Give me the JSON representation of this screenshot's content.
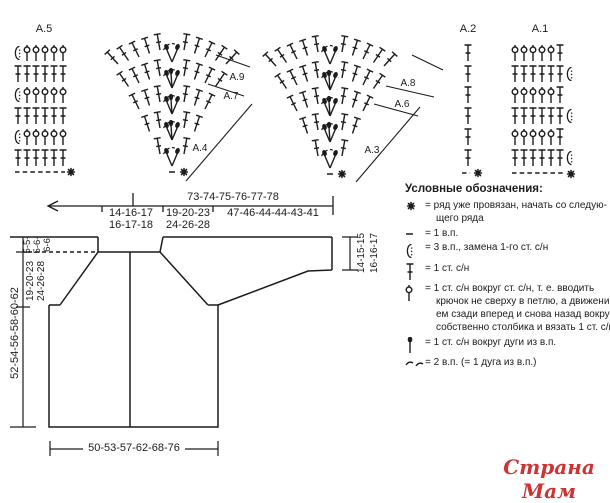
{
  "labels": {
    "a5": "А.5",
    "a2": "А.2",
    "a1": "А.1",
    "a9": "А.9",
    "a7": "А.7",
    "a4": "А.4",
    "a8": "А.8",
    "a6": "А.6",
    "a3": "А.3"
  },
  "top_dimension": {
    "total": "73-74-75-76-77-78",
    "seg1": [
      "14-16-17",
      "16-17-18"
    ],
    "seg2": [
      "19-20-23",
      "24-26-28"
    ],
    "seg3": "47-46-44-44-43-41"
  },
  "schematic": {
    "height_total": "52-54-56-58-60-62",
    "yoke_depth": [
      "19-20-23",
      "24-26-28"
    ],
    "neck_depth": [
      "5-5-",
      "5-6-",
      "6-6"
    ],
    "cuff_height": [
      "14-15-15",
      "16-16-17"
    ],
    "bottom_width": "50-53-57-62-68-76"
  },
  "legend": {
    "title": "Условные обозначения:",
    "items": [
      {
        "symbol": "star",
        "lines": [
          "= ряд уже провязан, начать со следую-",
          "щего ряда"
        ]
      },
      {
        "symbol": "chain1",
        "lines": [
          "= 1 в.п."
        ]
      },
      {
        "symbol": "chain3",
        "lines": [
          "= 3 в.п., замена 1-го ст. с/н"
        ]
      },
      {
        "symbol": "dc",
        "lines": [
          "= 1 ст. с/н"
        ]
      },
      {
        "symbol": "relief_dc",
        "lines": [
          "= 1 ст. с/н вокруг ст. с/н, т. е. вводить",
          "крючок не сверху в петлю, а движени-",
          "ем сзади вперед и снова назад вокруг",
          "собственно столбика и вязать 1 ст. с/н"
        ]
      },
      {
        "symbol": "dc_around_arc",
        "lines": [
          "= 1 ст. с/н вокруг дуги из в.п."
        ]
      },
      {
        "symbol": "arc2",
        "lines": [
          "= 2 в.п. (= 1 дуга из в.п.)"
        ]
      }
    ]
  },
  "watermark": "Страна Мам",
  "colors": {
    "ink": "#1c1c1c",
    "watermark": "#cc3333"
  }
}
